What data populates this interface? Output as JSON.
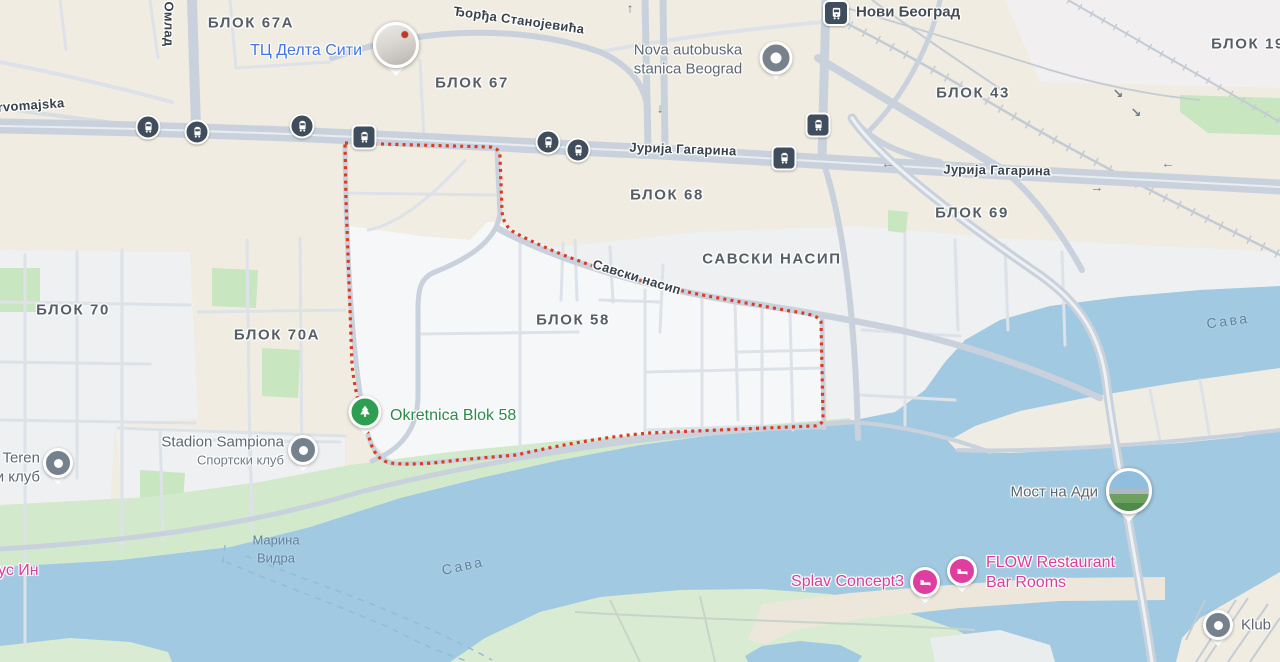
{
  "map": {
    "app": "maps-view",
    "colors": {
      "land": "#f0ece1",
      "district_gray": "#eef0f1",
      "block58_fill": "#f6f7f8",
      "water": "#a1c9e1",
      "green": "#d9ecd3",
      "green_patch": "#c8e6c0",
      "road": "#c9d2dc",
      "minor_road": "#dde2e8",
      "railway": "#c3cbd4",
      "boundary_red": "#dc3b26",
      "poi_blue": "#4274e3",
      "poi_green": "#2c8a4b",
      "poi_pink": "#db3d9b",
      "poi_gray": "#5d6772",
      "station_dark": "#454b51",
      "transit_bg": "#3f4d5c"
    },
    "area_labels": [
      {
        "name": "label-blok-67a",
        "text": "БЛОК 67А",
        "x": 251,
        "y": 23
      },
      {
        "name": "label-blok-67",
        "text": "БЛОК 67",
        "x": 472,
        "y": 83
      },
      {
        "name": "label-blok-68",
        "text": "БЛОК 68",
        "x": 667,
        "y": 195
      },
      {
        "name": "label-blok-43",
        "text": "БЛОК 43",
        "x": 973,
        "y": 93
      },
      {
        "name": "label-blok-19",
        "text": "БЛОК 19",
        "x": 1248,
        "y": 44
      },
      {
        "name": "label-blok-69",
        "text": "БЛОК 69",
        "x": 972,
        "y": 213
      },
      {
        "name": "label-blok-70",
        "text": "БЛОК 70",
        "x": 73,
        "y": 310
      },
      {
        "name": "label-blok-70a",
        "text": "БЛОК 70А",
        "x": 277,
        "y": 335
      },
      {
        "name": "label-blok-58",
        "text": "БЛОК 58",
        "x": 573,
        "y": 320
      },
      {
        "name": "label-savski-nasip-area",
        "text": "САВСКИ НАСИП",
        "x": 772,
        "y": 259
      }
    ],
    "street_labels": [
      {
        "name": "street-jurija-gagarina-1",
        "text": "Јурија Гагарина",
        "x": 683,
        "y": 149,
        "rot": 2
      },
      {
        "name": "street-jurija-gagarina-2",
        "text": "Јурија Гагарина",
        "x": 997,
        "y": 170,
        "rot": 1
      },
      {
        "name": "street-djordja-stanojevica",
        "text": "Ђорђа Станојевића",
        "x": 519,
        "y": 20,
        "rot": 8
      },
      {
        "name": "street-savski-nasip",
        "text": "Савски насип",
        "x": 637,
        "y": 277,
        "rot": 17
      },
      {
        "name": "street-prvomajska",
        "text": "rvomajska",
        "x": 31,
        "y": 105,
        "rot": -4
      },
      {
        "name": "street-omladinskih-brigada",
        "text": "Омлад",
        "x": 169,
        "y": 24,
        "rot": 90
      }
    ],
    "water_labels": [
      {
        "name": "water-label-sava-1",
        "lines": [
          "Сава"
        ],
        "x": 463,
        "y": 566,
        "rot": -12,
        "spaced": true
      },
      {
        "name": "water-label-sava-2",
        "lines": [
          "Сава"
        ],
        "x": 1228,
        "y": 321,
        "rot": -8,
        "spaced": true
      },
      {
        "name": "water-label-marina-vidra",
        "lines": [
          "Марина",
          "Видра"
        ],
        "x": 276,
        "y": 549,
        "rot": 0,
        "spaced": false
      }
    ],
    "pois": [
      {
        "name": "poi-tc-delta-siti",
        "lines": [
          "ТЦ Делта Сити"
        ],
        "color": "poi_blue",
        "x": 362,
        "y": 51,
        "align": "right",
        "size": 16,
        "marker": {
          "type": "photo-mall",
          "x": 396,
          "y": 45
        }
      },
      {
        "name": "poi-nova-autobuska-stanica",
        "lines": [
          "Nova autobuska",
          "stanica Beograd"
        ],
        "color": "poi_gray",
        "x": 688,
        "y": 60,
        "align": "center",
        "size": 15,
        "marker": {
          "type": "donut",
          "x": 776,
          "y": 58
        }
      },
      {
        "name": "poi-okretnica-blok-58",
        "lines": [
          "Okretnica Blok 58"
        ],
        "color": "poi_green",
        "x": 390,
        "y": 416,
        "align": "left",
        "size": 16,
        "marker": {
          "type": "pin-tree",
          "x": 365,
          "y": 412
        }
      },
      {
        "name": "poi-stadion-sampiona",
        "lines": [
          "Stadion Sampiona",
          "Спортски клуб"
        ],
        "color": "poi_gray",
        "x": 284,
        "y": 451,
        "align": "right",
        "size": 15,
        "sub": true,
        "marker": {
          "type": "pin-dot",
          "x": 303,
          "y": 450
        }
      },
      {
        "name": "poi-teren-klub",
        "lines": [
          "Teren",
          "и клуб"
        ],
        "color": "poi_gray",
        "x": 40,
        "y": 468,
        "align": "right",
        "size": 15,
        "marker": {
          "type": "pin-dot",
          "x": 58,
          "y": 463
        }
      },
      {
        "name": "poi-us-in",
        "lines": [
          "ус Ин"
        ],
        "color": "poi_pink",
        "x": -2,
        "y": 571,
        "align": "left",
        "size": 16,
        "marker": null
      },
      {
        "name": "poi-splav-concept3",
        "lines": [
          "Splav Concept3"
        ],
        "color": "poi_pink",
        "x": 904,
        "y": 582,
        "align": "right",
        "size": 16,
        "marker": {
          "type": "pin-bed",
          "x": 925,
          "y": 582
        }
      },
      {
        "name": "poi-flow-restaurant-bar-rooms",
        "lines": [
          "FLOW Restaurant",
          "Bar Rooms"
        ],
        "color": "poi_pink",
        "x": 986,
        "y": 573,
        "align": "left",
        "size": 16,
        "marker": {
          "type": "pin-bed",
          "x": 962,
          "y": 571
        }
      },
      {
        "name": "poi-most-na-adi",
        "lines": [
          "Мост на Ади"
        ],
        "color": "poi_gray",
        "x": 1098,
        "y": 493,
        "align": "right",
        "size": 15,
        "marker": {
          "type": "photo-bridge",
          "x": 1129,
          "y": 491
        }
      },
      {
        "name": "poi-klub",
        "lines": [
          "Klub"
        ],
        "color": "poi_gray",
        "x": 1241,
        "y": 626,
        "align": "left",
        "size": 15,
        "marker": {
          "type": "pin-dot",
          "x": 1218,
          "y": 625
        }
      },
      {
        "name": "poi-novi-beograd-station",
        "lines": [
          "Нови Београд"
        ],
        "color": "station_dark",
        "x": 856,
        "y": 13,
        "align": "left",
        "size": 15,
        "bold": true,
        "marker": {
          "type": "train-badge",
          "x": 836,
          "y": 13
        }
      }
    ],
    "transit_stops": [
      {
        "x": 148,
        "y": 127
      },
      {
        "x": 197,
        "y": 132
      },
      {
        "x": 302,
        "y": 126
      },
      {
        "x": 548,
        "y": 142
      },
      {
        "x": 578,
        "y": 150
      },
      {
        "x": 364,
        "y": 137,
        "sq": true
      },
      {
        "x": 818,
        "y": 125,
        "sq": true
      },
      {
        "x": 784,
        "y": 158,
        "sq": true
      }
    ],
    "road_arrows": [
      {
        "g": "←",
        "x": 888,
        "y": 163
      },
      {
        "g": "←",
        "x": 1168,
        "y": 163
      },
      {
        "g": "→",
        "x": 1097,
        "y": 187
      },
      {
        "g": "↑",
        "x": 630,
        "y": 8
      },
      {
        "g": "↓",
        "x": 660,
        "y": 108
      },
      {
        "g": "↘",
        "x": 1118,
        "y": 94
      },
      {
        "g": "↘",
        "x": 1136,
        "y": 113
      }
    ]
  }
}
